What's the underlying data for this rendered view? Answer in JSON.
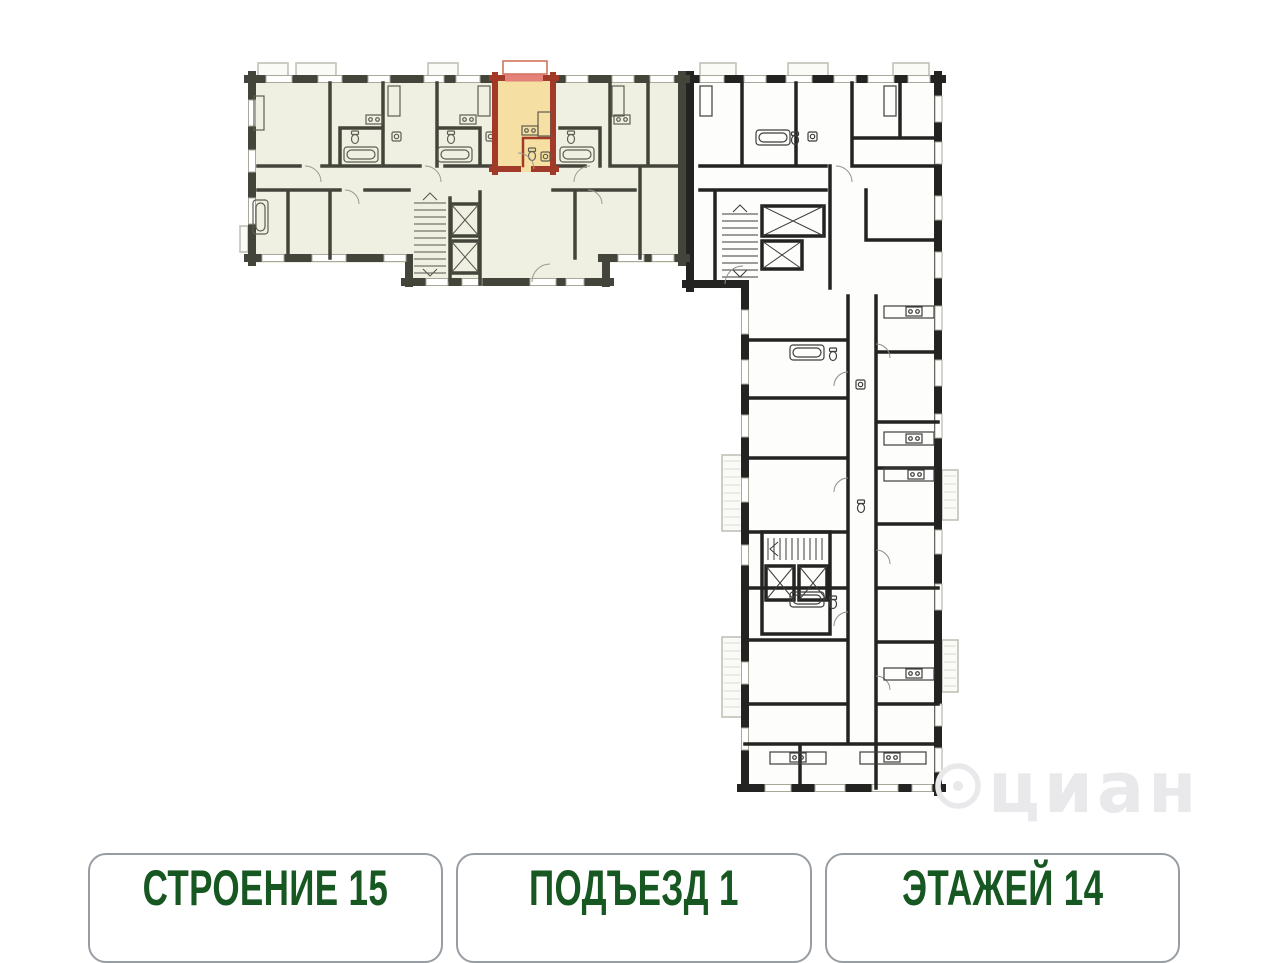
{
  "plan": {
    "watermark": "циан"
  },
  "footer": {
    "items": [
      {
        "label": "СТРОЕНИЕ 15"
      },
      {
        "label": "ПОДЪЕЗД 1"
      },
      {
        "label": "ЭТАЖЕЙ 14"
      }
    ]
  },
  "theme": {
    "page-bg": "#ffffff",
    "selected-fill": "#eff0e2",
    "selected-wall": "#44453a",
    "plain-fill": "#fdfdfc",
    "plain-wall": "#232322",
    "apartment-fill": "#f5dfa2",
    "apartment-wall": "#a13a28",
    "apartment-window": "#e4827a",
    "window-stroke": "#a9a99b",
    "fixture-green": "#5d5d50",
    "fixture-dark": "#3d3d3d",
    "watermark": "#e9e9ec",
    "footer-green": "#175721",
    "footer-border": "#979da3"
  }
}
